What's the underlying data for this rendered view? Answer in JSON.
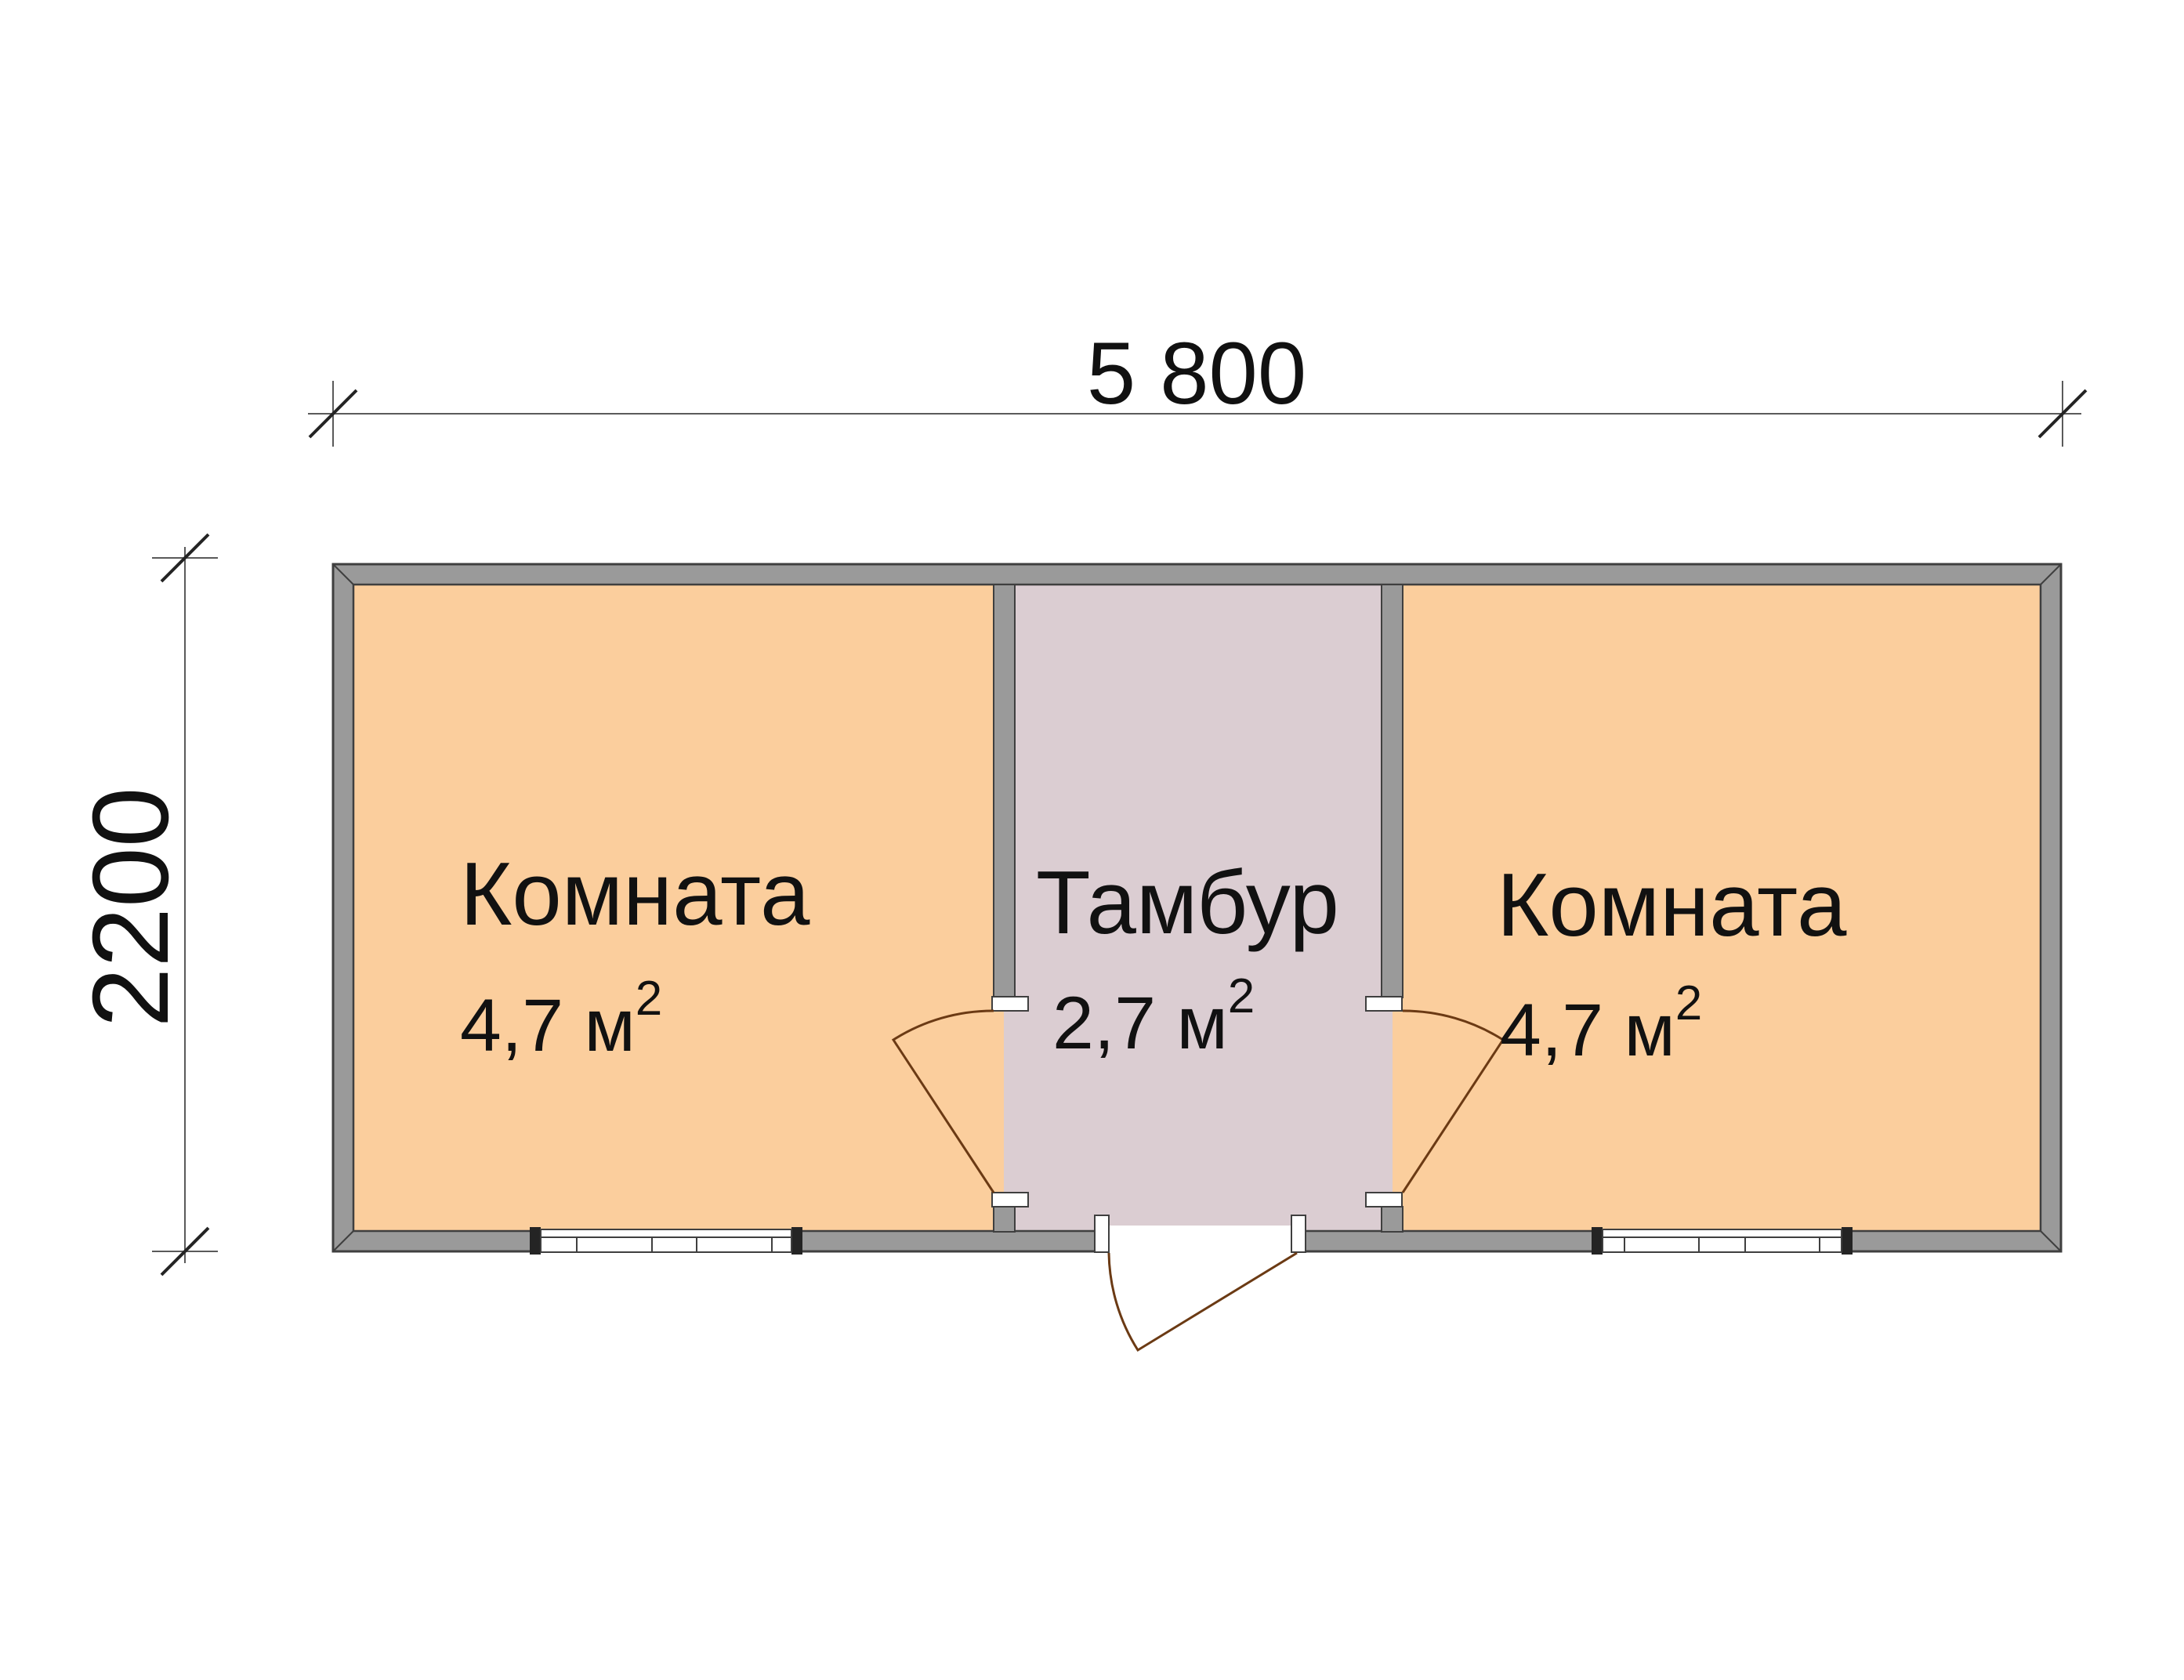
{
  "dimensions": {
    "width_label": "5 800",
    "height_label": "2200"
  },
  "rooms": [
    {
      "name": "Комната",
      "area_label": "4,7 м",
      "area_sup": "2"
    },
    {
      "name": "Тамбур",
      "area_label": "2,7 м",
      "area_sup": "2"
    },
    {
      "name": "Комната",
      "area_label": "4,7 м",
      "area_sup": "2"
    }
  ],
  "colors": {
    "background": "#FFFFFF",
    "white_fill": "#FFFFFF",
    "room_fill": "#FBCE9D",
    "vestibule_fill": "#DBCDD2",
    "wall_fill": "#9A9A9A",
    "wall_outline": "#3F3F3F",
    "window_cap": "#242424",
    "door_line": "#6B3A14",
    "dim_line": "#5A5A5A",
    "text": "#111111"
  }
}
